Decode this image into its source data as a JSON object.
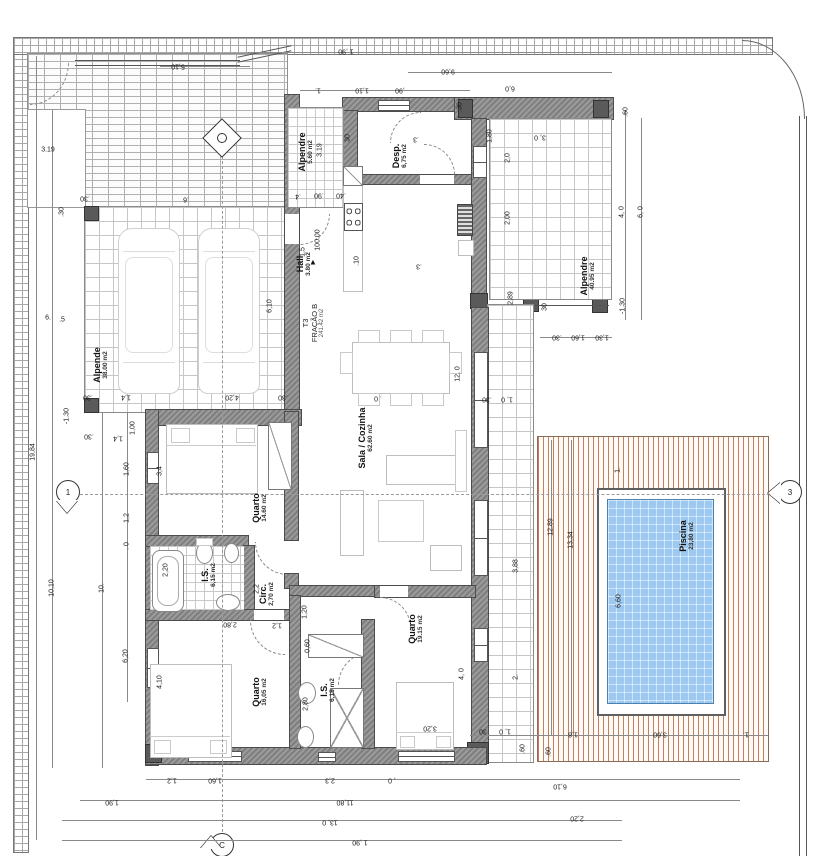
{
  "drawing": {
    "kind": "architectural floor plan",
    "title": {
      "line1": "T3",
      "line2": "FRAÇÃO B",
      "line3": "241.42 m2"
    }
  },
  "colors": {
    "wall": "#8a8a8a",
    "line": "#444444",
    "pool_water": "#9dc9f0",
    "pool_border": "#4d7fae",
    "deck_wood": "#c4805a",
    "tile_grid": "#c6c6c6",
    "brick": "#b0b0b0",
    "furniture": "#bdbdbd"
  },
  "markers": {
    "section_bottom": "C",
    "section_left": "1",
    "section_right": "3",
    "level_value": "100.00",
    "level_arrow": "▲"
  },
  "rooms": [
    {
      "id": "alpende-carport",
      "name": "Alpende",
      "area": "38.00 m2",
      "x": 101,
      "y": 365
    },
    {
      "id": "alpendre-entry",
      "name": "Alpendre",
      "area": "5.60 m2",
      "x": 306,
      "y": 152
    },
    {
      "id": "desp",
      "name": "Desp.",
      "area": "6,75 m2",
      "x": 400,
      "y": 156
    },
    {
      "id": "hall",
      "name": "Hall",
      "area": "3.80 m2",
      "x": 304,
      "y": 264
    },
    {
      "id": "sala-cozinha",
      "name": "Sala / Cozinha",
      "area": "62.60 m2",
      "x": 366,
      "y": 438
    },
    {
      "id": "alpendre-poente",
      "name": "Alpendre",
      "area": "40.95 m2",
      "x": 588,
      "y": 276
    },
    {
      "id": "quarto-1",
      "name": "Quarto",
      "area": "14.60 m2",
      "x": 260,
      "y": 508
    },
    {
      "id": "is-1",
      "name": "I.S.",
      "area": "6,15 m2",
      "x": 209,
      "y": 575
    },
    {
      "id": "circ",
      "name": "Circ.",
      "area": "2,70 m2",
      "x": 267,
      "y": 594
    },
    {
      "id": "quarto-2",
      "name": "Quarto",
      "area": "16,05 m2",
      "x": 260,
      "y": 692
    },
    {
      "id": "is-2",
      "name": "I.S.",
      "area": "6,15 m2",
      "x": 328,
      "y": 690
    },
    {
      "id": "quarto-3",
      "name": "Quarto",
      "area": "19.15 m2",
      "x": 416,
      "y": 629
    },
    {
      "id": "piscina",
      "name": "Piscina",
      "area": "23,80 m2",
      "x": 687,
      "y": 536
    }
  ],
  "dims": [
    {
      "t": "5,10",
      "x": 178,
      "y": 66,
      "r": "u"
    },
    {
      "t": "1 ,90",
      "x": 346,
      "y": 51,
      "r": "u"
    },
    {
      "t": "9,60",
      "x": 448,
      "y": 71,
      "r": "u"
    },
    {
      "t": "6,0",
      "x": 510,
      "y": 88,
      "r": "u"
    },
    {
      "t": "1.",
      "x": 318,
      "y": 90,
      "r": "u"
    },
    {
      "t": "1,10",
      "x": 362,
      "y": 90,
      "r": "u"
    },
    {
      "t": ",90",
      "x": 400,
      "y": 90,
      "r": "u"
    },
    {
      "t": ".30",
      "x": 460,
      "y": 107,
      "r": "v"
    },
    {
      "t": ".60",
      "x": 626,
      "y": 112,
      "r": "v"
    },
    {
      "t": "3, 0",
      "x": 540,
      "y": 137,
      "r": "u"
    },
    {
      "t": "1,80",
      "x": 490,
      "y": 136,
      "r": "v"
    },
    {
      "t": "2,0",
      "x": 508,
      "y": 158,
      "r": "v"
    },
    {
      "t": "2,00",
      "x": 508,
      "y": 218,
      "r": "v"
    },
    {
      "t": "2,89",
      "x": 511,
      "y": 298,
      "r": "v"
    },
    {
      "t": "4, 0",
      "x": 622,
      "y": 212,
      "r": "v"
    },
    {
      "t": "6, 0",
      "x": 641,
      "y": 212,
      "r": "v"
    },
    {
      "t": "-1.30",
      "x": 623,
      "y": 306,
      "r": "v"
    },
    {
      "t": "30",
      "x": 545,
      "y": 307,
      "r": "v"
    },
    {
      "t": ".30",
      "x": 557,
      "y": 337,
      "r": "u"
    },
    {
      "t": "1,60",
      "x": 578,
      "y": 337,
      "r": "u"
    },
    {
      "t": "1,30",
      "x": 602,
      "y": 337,
      "r": "u"
    },
    {
      "t": ".30",
      "x": 487,
      "y": 399,
      "r": "u"
    },
    {
      "t": "1, 0",
      "x": 507,
      "y": 399,
      "r": "u"
    },
    {
      "t": ".4",
      "x": 298,
      "y": 196,
      "r": "u"
    },
    {
      "t": ".90",
      "x": 319,
      "y": 195,
      "r": "u"
    },
    {
      "t": ".40",
      "x": 341,
      "y": 195,
      "r": "u"
    },
    {
      "t": "3.19",
      "x": 320,
      "y": 150,
      "r": "v"
    },
    {
      "t": "30",
      "x": 348,
      "y": 138,
      "r": "v"
    },
    {
      "t": "1,5",
      "x": 303,
      "y": 252,
      "r": "v"
    },
    {
      "t": ".10",
      "x": 357,
      "y": 261,
      "r": "v"
    },
    {
      "t": ".3",
      "x": 416,
      "y": 139,
      "r": "u"
    },
    {
      "t": ".3",
      "x": 419,
      "y": 266,
      "r": "u"
    },
    {
      "t": "12, 0",
      "x": 458,
      "y": 374,
      "r": "v"
    },
    {
      "t": ". 0",
      "x": 378,
      "y": 398,
      "r": "u"
    },
    {
      "t": "3.19",
      "x": 48,
      "y": 150,
      "r": "h"
    },
    {
      "t": "19,84",
      "x": 33,
      "y": 452,
      "r": "v"
    },
    {
      "t": "6.",
      "x": 48,
      "y": 318,
      "r": "h"
    },
    {
      "t": ".5",
      "x": 62,
      "y": 320,
      "r": "h"
    },
    {
      "t": ".30",
      "x": 85,
      "y": 198,
      "r": "u"
    },
    {
      "t": ".30",
      "x": 62,
      "y": 212,
      "r": "v"
    },
    {
      "t": "10,10",
      "x": 52,
      "y": 588,
      "r": "v"
    },
    {
      "t": "10.",
      "x": 102,
      "y": 588,
      "r": "v"
    },
    {
      "t": "-1.30",
      "x": 67,
      "y": 416,
      "r": "v"
    },
    {
      "t": ".30",
      "x": 89,
      "y": 436,
      "r": "u"
    },
    {
      "t": "1,4",
      "x": 118,
      "y": 438,
      "r": "u"
    },
    {
      "t": "1,00",
      "x": 133,
      "y": 428,
      "r": "v"
    },
    {
      "t": "1,60",
      "x": 127,
      "y": 469,
      "r": "v"
    },
    {
      "t": "1,2",
      "x": 127,
      "y": 518,
      "r": "v"
    },
    {
      "t": ". 0",
      "x": 127,
      "y": 546,
      "r": "v"
    },
    {
      "t": "6,20",
      "x": 126,
      "y": 656,
      "r": "v"
    },
    {
      "t": "3,4",
      "x": 160,
      "y": 471,
      "r": "v"
    },
    {
      "t": "4,10",
      "x": 160,
      "y": 682,
      "r": "v"
    },
    {
      "t": "2,20",
      "x": 166,
      "y": 570,
      "r": "v"
    },
    {
      "t": ".6",
      "x": 186,
      "y": 199,
      "r": "u"
    },
    {
      "t": ".30",
      "x": 88,
      "y": 397,
      "r": "u"
    },
    {
      "t": "1,4",
      "x": 126,
      "y": 397,
      "r": "u"
    },
    {
      "t": "4,20",
      "x": 232,
      "y": 397,
      "r": "u"
    },
    {
      "t": ".30",
      "x": 283,
      "y": 397,
      "r": "u"
    },
    {
      "t": "6,10",
      "x": 270,
      "y": 306,
      "r": "v"
    },
    {
      "t": "1,20",
      "x": 305,
      "y": 612,
      "r": "v"
    },
    {
      "t": "0,60",
      "x": 308,
      "y": 646,
      "r": "v"
    },
    {
      "t": "2,80",
      "x": 306,
      "y": 704,
      "r": "v"
    },
    {
      "t": "2,2",
      "x": 257,
      "y": 589,
      "r": "v"
    },
    {
      "t": "2,80",
      "x": 230,
      "y": 624,
      "r": "u"
    },
    {
      "t": "1,2",
      "x": 277,
      "y": 625,
      "r": "u"
    },
    {
      "t": "3,20",
      "x": 430,
      "y": 728,
      "r": "u"
    },
    {
      "t": "4, 0",
      "x": 462,
      "y": 674,
      "r": "v"
    },
    {
      "t": "1,2",
      "x": 172,
      "y": 780,
      "r": "u"
    },
    {
      "t": "1,60",
      "x": 215,
      "y": 780,
      "r": "u"
    },
    {
      "t": "2,3",
      "x": 330,
      "y": 780,
      "r": "u"
    },
    {
      "t": ", 0",
      "x": 392,
      "y": 780,
      "r": "u"
    },
    {
      "t": "6,10",
      "x": 560,
      "y": 786,
      "r": "u"
    },
    {
      "t": "1,90",
      "x": 112,
      "y": 802,
      "r": "u"
    },
    {
      "t": "11,80",
      "x": 345,
      "y": 802,
      "r": "u"
    },
    {
      "t": "13, 0",
      "x": 330,
      "y": 822,
      "r": "u"
    },
    {
      "t": "1 ,90",
      "x": 360,
      "y": 842,
      "r": "u"
    },
    {
      "t": "2,20",
      "x": 577,
      "y": 818,
      "r": "u"
    },
    {
      "t": "30",
      "x": 483,
      "y": 731,
      "r": "u"
    },
    {
      "t": "1, 0",
      "x": 505,
      "y": 731,
      "r": "u"
    },
    {
      "t": ".60",
      "x": 523,
      "y": 749,
      "r": "v"
    },
    {
      "t": ".60",
      "x": 549,
      "y": 752,
      "r": "v"
    },
    {
      "t": "1,8",
      "x": 573,
      "y": 734,
      "r": "u"
    },
    {
      "t": "3,60",
      "x": 660,
      "y": 734,
      "r": "u"
    },
    {
      "t": "1.",
      "x": 746,
      "y": 734,
      "r": "u"
    },
    {
      "t": "1.",
      "x": 618,
      "y": 470,
      "r": "v"
    },
    {
      "t": "12,89",
      "x": 551,
      "y": 527,
      "r": "v"
    },
    {
      "t": "13,34",
      "x": 571,
      "y": 540,
      "r": "v"
    },
    {
      "t": "3,88",
      "x": 516,
      "y": 566,
      "r": "v"
    },
    {
      "t": "6,60",
      "x": 619,
      "y": 601,
      "r": "v"
    },
    {
      "t": "2.",
      "x": 516,
      "y": 677,
      "r": "v"
    }
  ]
}
